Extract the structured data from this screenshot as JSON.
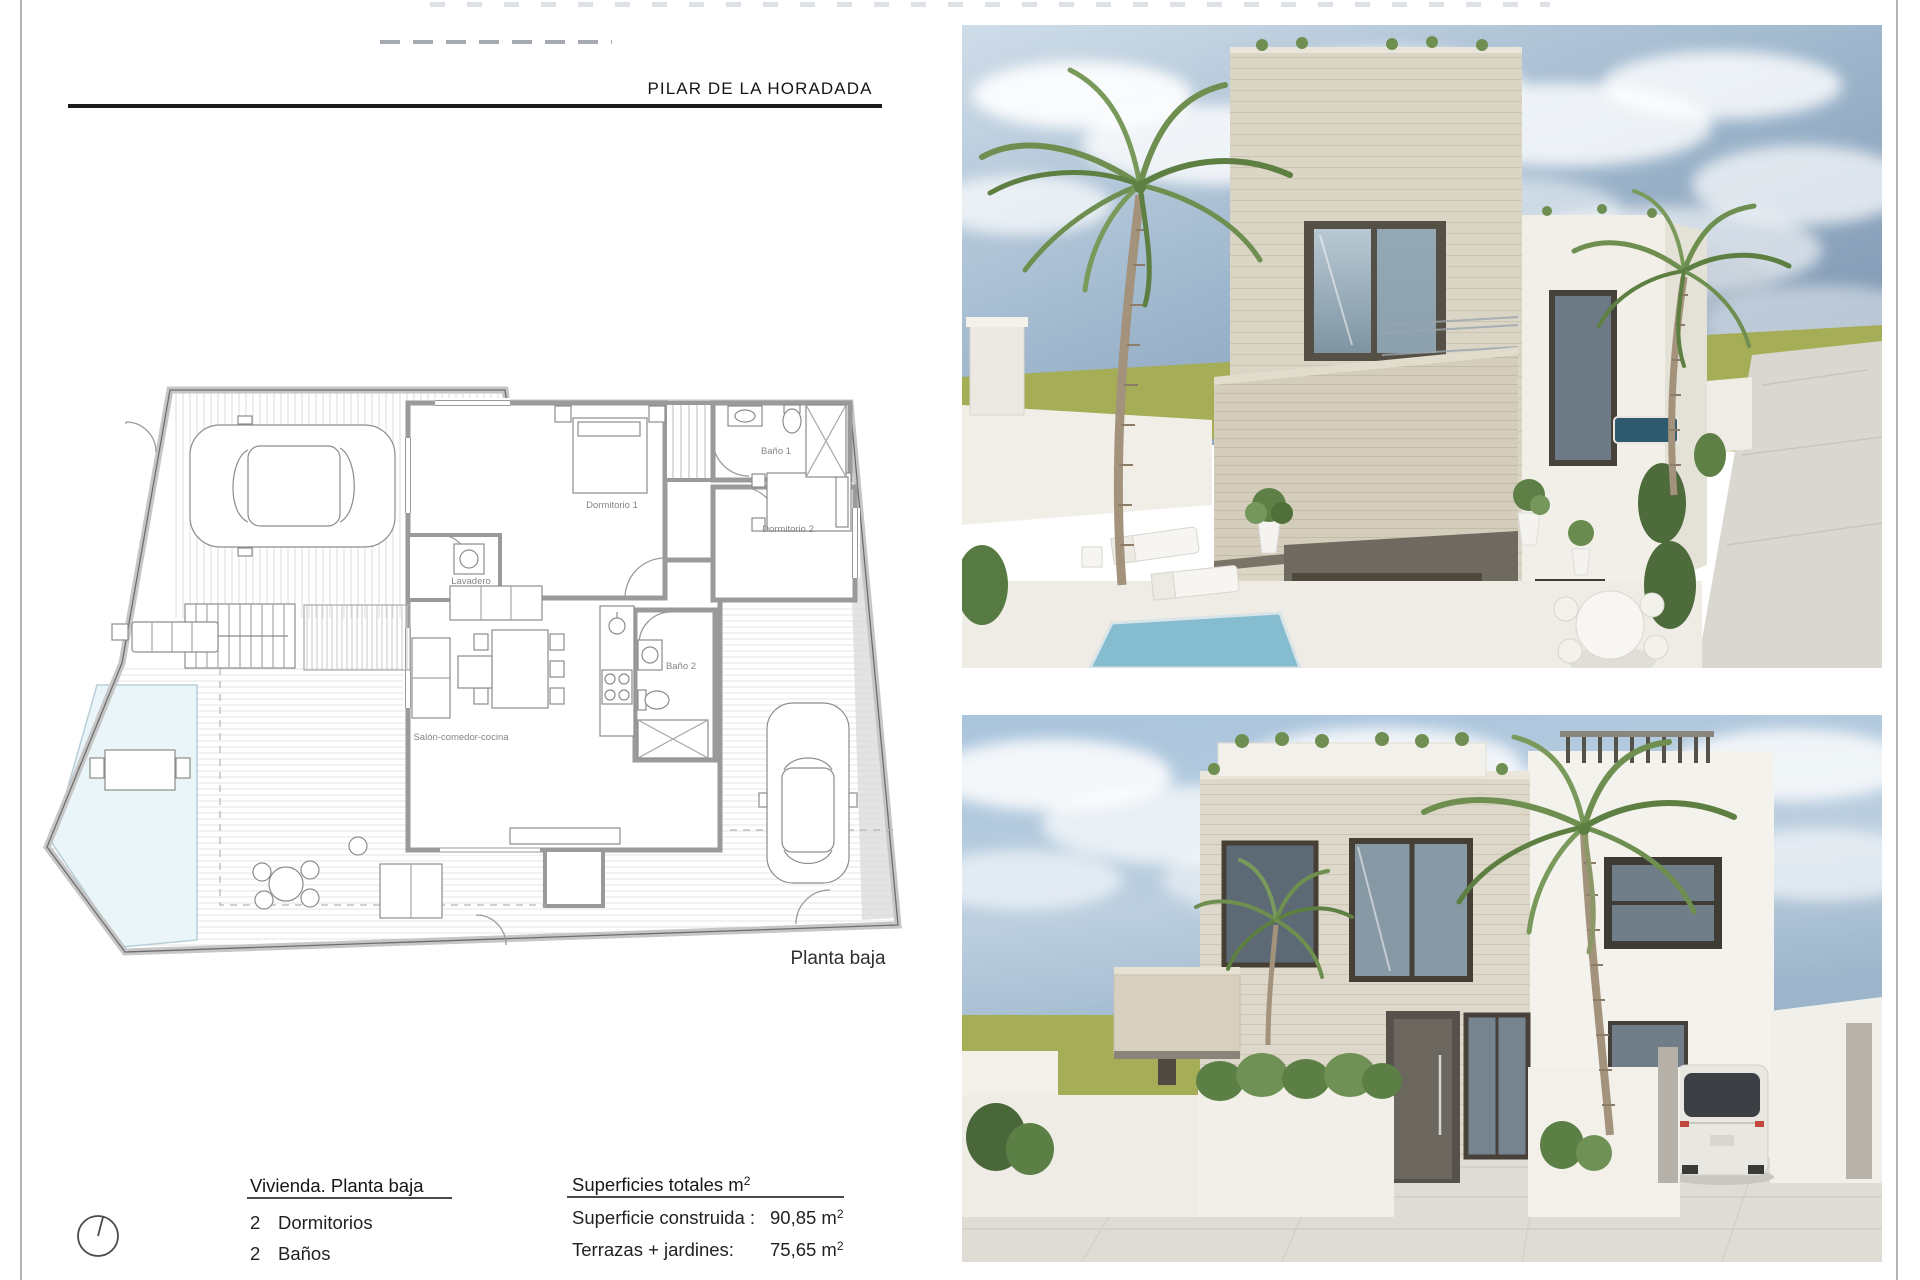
{
  "page": {
    "title": "PILAR DE LA HORADADA"
  },
  "plan": {
    "caption": "Planta baja",
    "rooms": {
      "dormitorio1": "Dormitorio 1",
      "bano1": "Baño 1",
      "dormitorio2": "Dormitorio 2",
      "lavadero": "Lavadero",
      "bano2": "Baño 2",
      "salon": "Salón-comedor-cocina"
    }
  },
  "info": {
    "heading": "Vivienda. Planta baja",
    "rooms": [
      {
        "qty": "2",
        "label": "Dormitorios"
      },
      {
        "qty": "2",
        "label": "Baños"
      }
    ]
  },
  "surfaces": {
    "heading": "Superficies totales m",
    "heading_sup": "2",
    "rows": [
      {
        "label": "Superficie construida :",
        "value": "90,85 m",
        "sup": "2"
      },
      {
        "label": "Terrazas + jardines:",
        "value": "75,65 m",
        "sup": "2"
      }
    ]
  },
  "icons": {
    "north_indicator": "north-circle-icon"
  },
  "colors": {
    "ink": "#1a1a1a",
    "plan_wall": "#9a9a9a",
    "plan_label": "#858585",
    "pool": "#e9f5f9",
    "sky": "#a9c2d8",
    "lawn": "#a6ad57",
    "stone": "#dbd5c6",
    "white_wall": "#f2f0ea",
    "window_frame": "#4c463c",
    "glass": "#8b9fae",
    "palm": "#6e8f50",
    "trunk": "#a3927c",
    "paving": "#dedcd4"
  }
}
